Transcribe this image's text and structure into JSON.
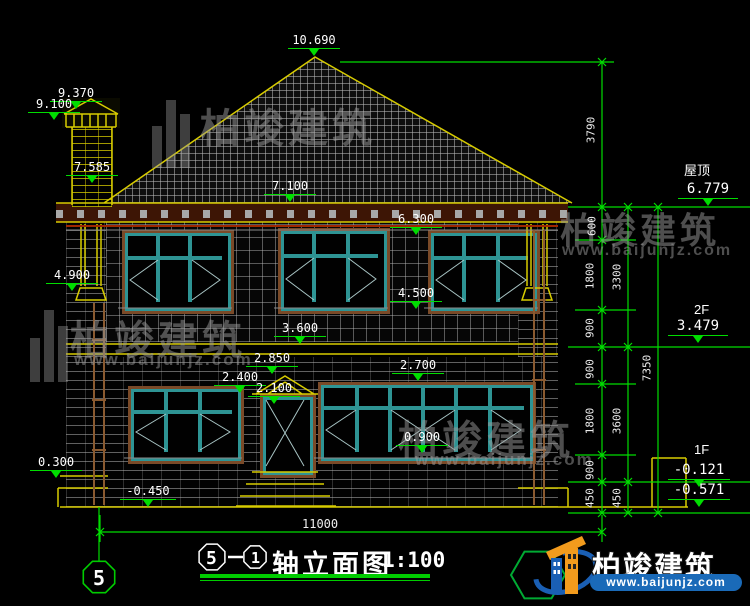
{
  "title": {
    "axis_from": "5",
    "axis_to": "1",
    "text": "轴立面图",
    "scale": "1:100"
  },
  "axis_marker": "5",
  "levels": {
    "roof_label": "屋顶",
    "roof": "6.779",
    "f2_label": "2F",
    "f2": "3.479",
    "f1_label": "1F",
    "f1_top": "-0.121",
    "f1_bottom": "-0.571"
  },
  "elev": {
    "e10690": "10.690",
    "e9370": "9.370",
    "e9100": "9.100",
    "e7585": "7.585",
    "e7100": "7.100",
    "e6300": "6.300",
    "e4900": "4.900",
    "e4500": "4.500",
    "e3600": "3.600",
    "e2850": "2.850",
    "e2400": "2.400",
    "e2100": "2.100",
    "e2700": "2.700",
    "e0900": "0.900",
    "e0300": "0.300",
    "em0450": "-0.450"
  },
  "dims": {
    "total_width": "11000",
    "chain_a": [
      "3790",
      "600",
      "1800",
      "900",
      "900",
      "1800",
      "900",
      "450"
    ],
    "chain_b": [
      "3300",
      "3600",
      "450"
    ],
    "chain_c": [
      "7350"
    ]
  },
  "watermark": {
    "brand": "柏竣建筑",
    "url": "www.baijunjz.com"
  },
  "logo": {
    "brand": "柏竣建筑",
    "url": "www.baijunjz.com"
  }
}
